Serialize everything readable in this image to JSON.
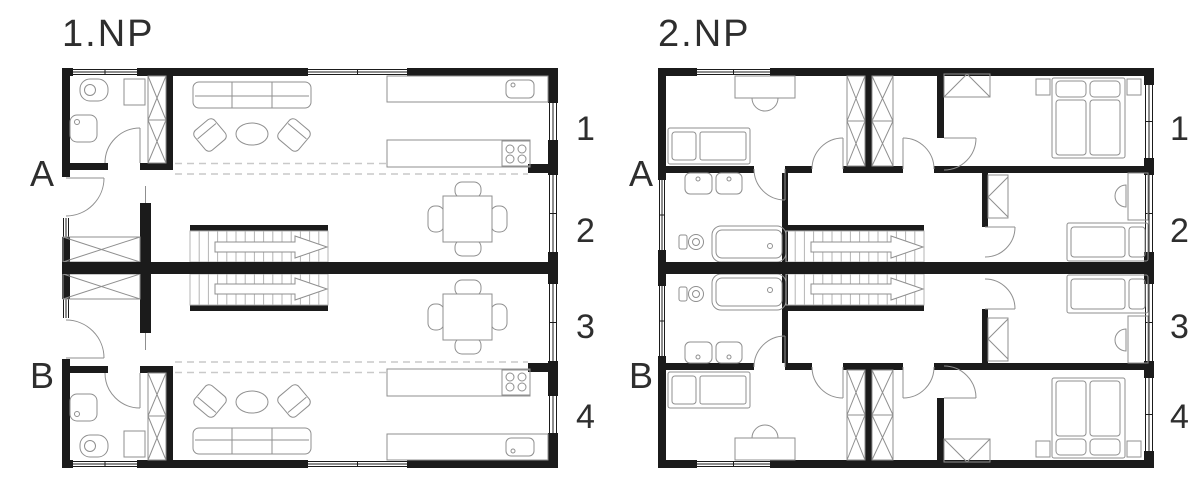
{
  "plans": [
    {
      "title": "1.NP",
      "row_labels": [
        "A",
        "B"
      ],
      "room_numbers": [
        "1",
        "2",
        "3",
        "4"
      ],
      "unit_symbols": [
        "entry-door",
        "storage-closet",
        "bathroom-wc",
        "sink",
        "wardrobe",
        "sofa",
        "armchairs",
        "coffee-table",
        "kitchen-counter-with-sink",
        "kitchen-island-with-cooktop",
        "dining-table-four-chairs",
        "staircase-with-up-arrow"
      ]
    },
    {
      "title": "2.NP",
      "row_labels": [
        "A",
        "B"
      ],
      "room_numbers": [
        "1",
        "2",
        "3",
        "4"
      ],
      "unit_symbols": [
        "desk-with-chair",
        "single-bed",
        "corridor-wardrobes",
        "master-double-bed",
        "nightstands",
        "bathroom-two-sinks",
        "bathtub",
        "wc",
        "staircase-with-up-arrow"
      ]
    }
  ],
  "colors": {
    "wall": "#1b1b1b",
    "furn": "#8f8f8f",
    "stairs": "#b4b4b4",
    "dashed": "#c9c9c9",
    "text": "#2e2e2e",
    "bg": "#ffffff"
  }
}
